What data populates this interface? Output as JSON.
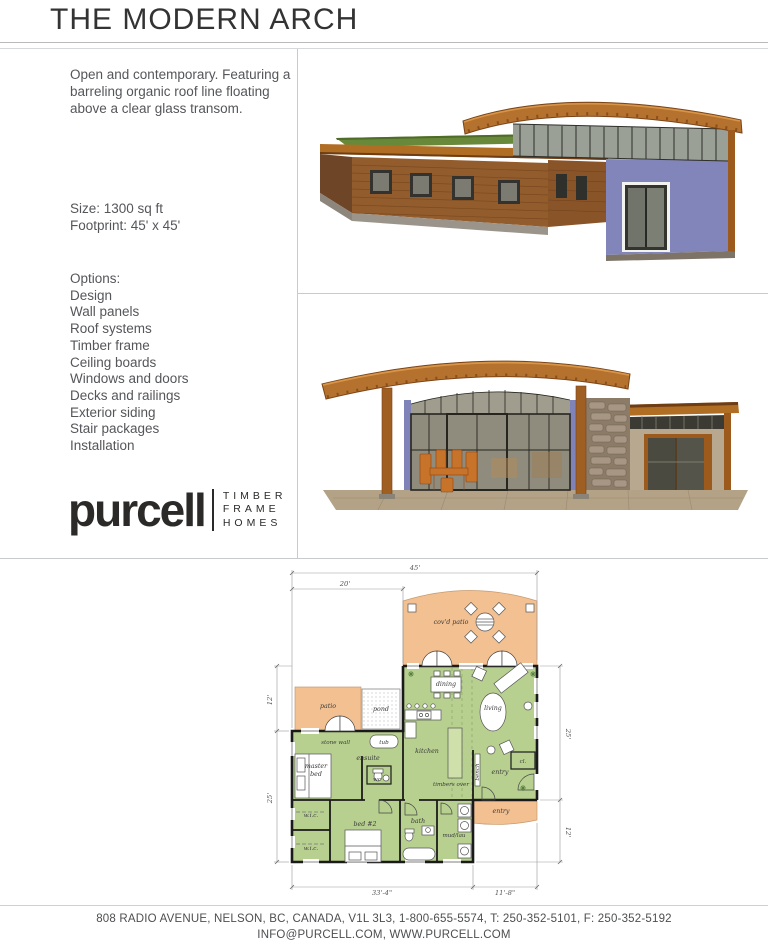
{
  "page": {
    "title": "THE MODERN ARCH"
  },
  "left_column": {
    "description": "Open and contemporary. Featuring a barreling organic roof line floating above a clear glass transom.",
    "size_line": "Size: 1300 sq ft",
    "footprint_line": "Footprint: 45' x 45'",
    "options_heading": "Options:",
    "options": [
      "Design",
      "Wall panels",
      "Roof systems",
      "Timber frame",
      "Ceiling boards",
      "Windows and doors",
      "Decks and railings",
      "Exterior siding",
      "Stair packages",
      "Installation"
    ]
  },
  "logo": {
    "wordmark": "purcell",
    "tagline": [
      "TIMBER",
      "FRAME",
      "HOMES"
    ]
  },
  "images": {
    "top_rendering": "exterior-perspective-rendering",
    "bottom_rendering": "covered-patio-elevation-rendering"
  },
  "floor_plan": {
    "labels": {
      "covd_patio": "cov'd patio",
      "patio": "patio",
      "pond": "pond",
      "dining": "dining",
      "living": "living",
      "kitchen": "kitchen",
      "stone_wall": "stone wall",
      "tub": "tub",
      "ensuite": "ensuite",
      "master_1": "master",
      "master_2": "bed",
      "wc": "wc",
      "wic_1": "w.i.c.",
      "wic_2": "w.i.c.",
      "bed2": "bed #2",
      "bath": "bath",
      "mud_lau": "mud/lau",
      "bench": "bench",
      "entry_interior": "entry",
      "closet": "cl.",
      "timbers_over": "timbers over",
      "entry_porch": "entry"
    },
    "dimensions": {
      "overall_width": "45'",
      "left_width": "20'",
      "left_upper_depth": "12'",
      "left_lower_depth": "25'",
      "right_upper_depth": "25'",
      "right_lower_depth": "12'",
      "bottom_left_width": "33'-4\"",
      "bottom_right_width": "11'-8\""
    }
  },
  "footer": {
    "line1": "808 RADIO AVENUE, NELSON, BC, CANADA, V1L 3L3, 1-800-655-5574, T: 250-352-5101, F: 250-352-5192",
    "line2": "INFO@PURCELL.COM, WWW.PURCELL.COM"
  },
  "colors": {
    "wood": "#b06d24",
    "wood_dark": "#7a4418",
    "roof_green": "#68893a",
    "wall_purple": "#8285b9",
    "plan_green": "#b7d08f",
    "plan_peach": "#f2c091",
    "text_gray": "#58595b",
    "rule_gray": "#c9cacb"
  }
}
